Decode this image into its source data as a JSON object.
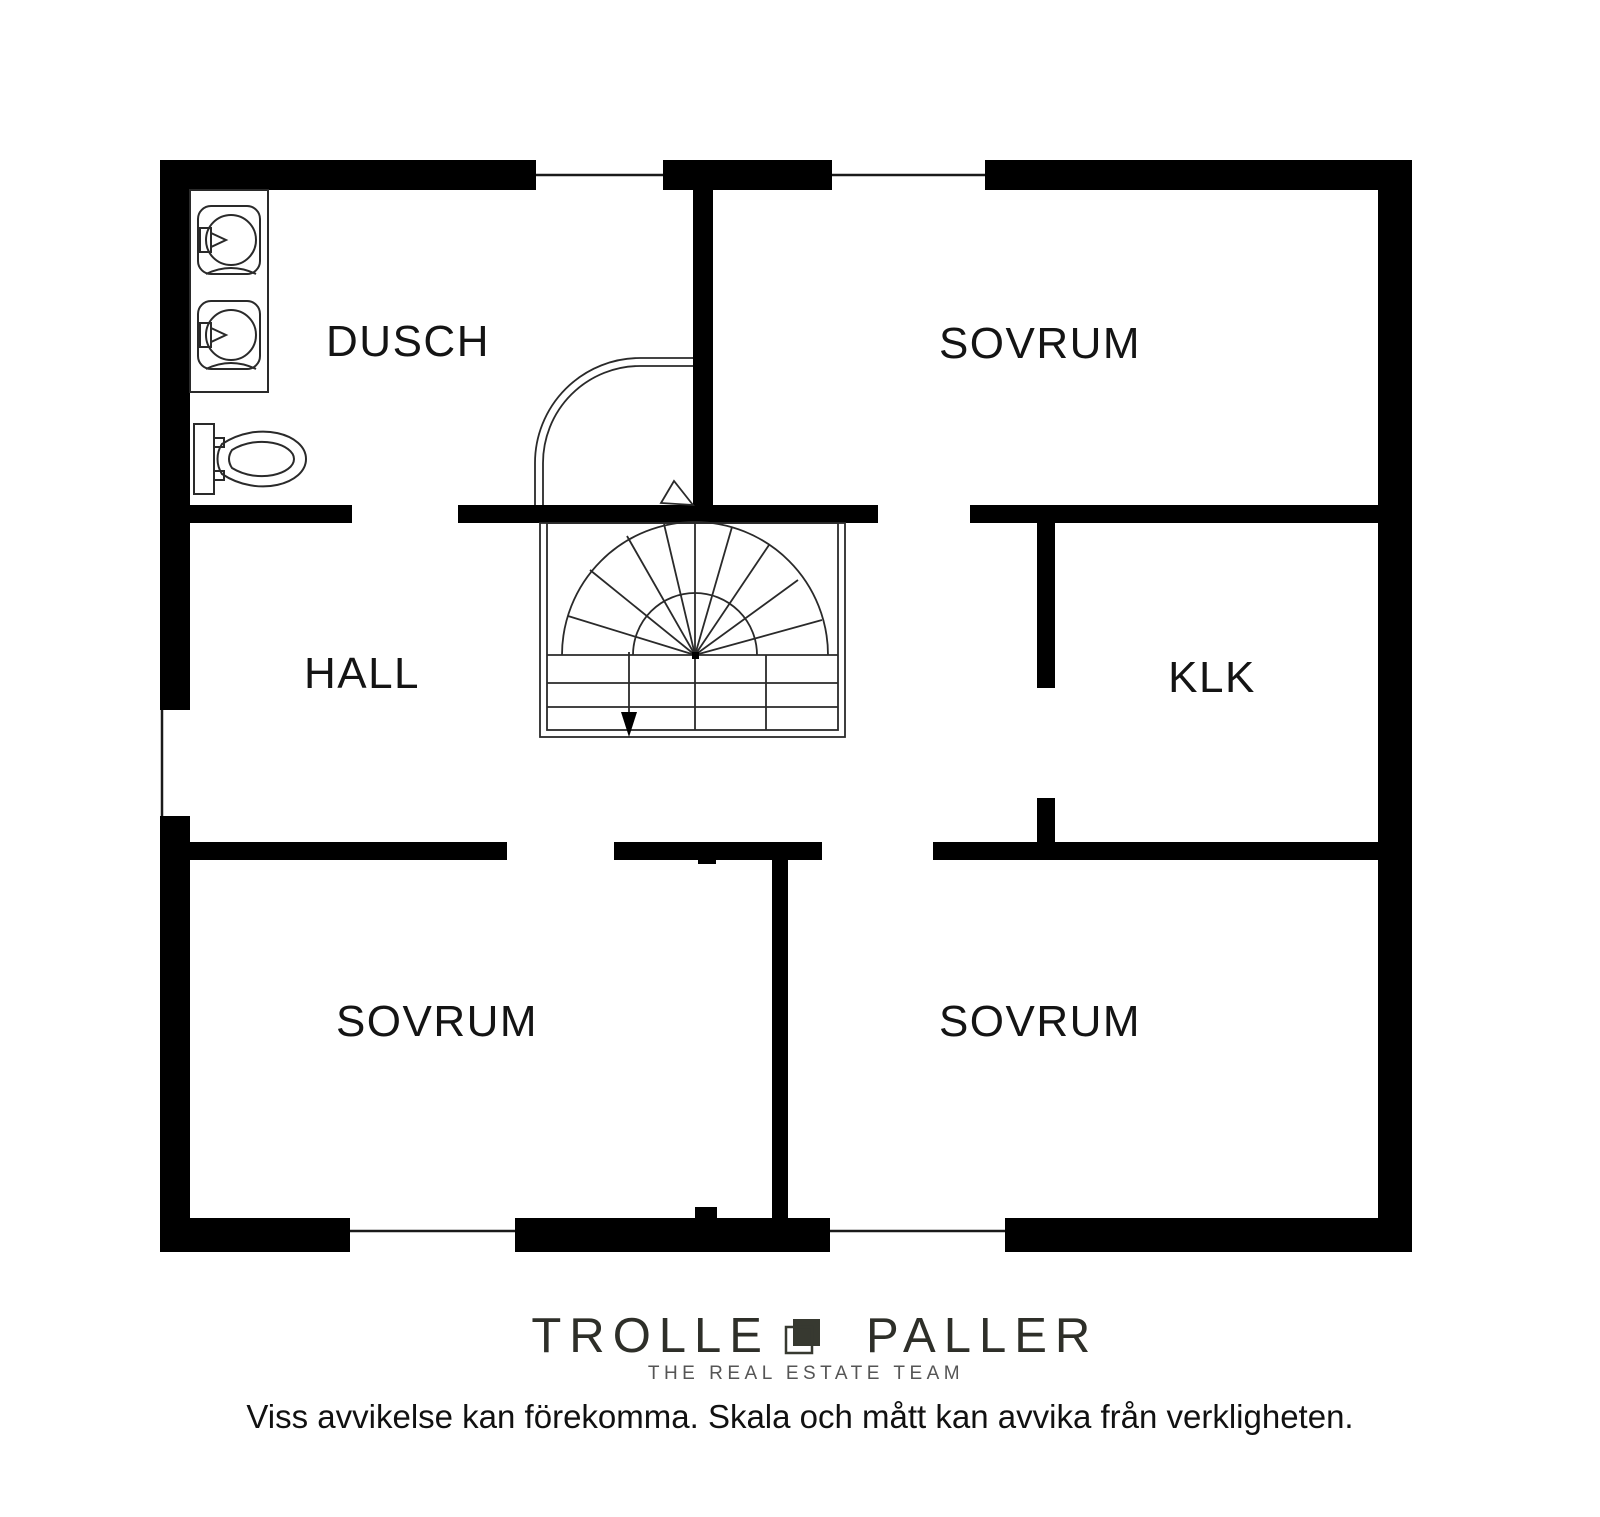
{
  "floor_plan": {
    "rooms": {
      "dusch": {
        "label": "DUSCH"
      },
      "sovrum_ne": {
        "label": "SOVRUM"
      },
      "hall": {
        "label": "HALL"
      },
      "klk": {
        "label": "KLK"
      },
      "sovrum_sw": {
        "label": "SOVRUM"
      },
      "sovrum_se": {
        "label": "SOVRUM"
      }
    },
    "fixtures": [
      "double-sink-vanity",
      "toilet",
      "winder-staircase",
      "door-swing"
    ],
    "stair_direction": "down"
  },
  "branding": {
    "brand_left": "TROLLE",
    "brand_right": "PALLER",
    "tagline": "THE REAL ESTATE TEAM"
  },
  "disclaimer": "Viss avvikelse kan förekomma. Skala och mått kan avvika från verkligheten.",
  "colors": {
    "wall": "#000000",
    "label_text": "#141414",
    "logo": "#2e2f29",
    "logo_mark": "#373930",
    "tagline_gray": "#555555",
    "background": "#ffffff"
  }
}
